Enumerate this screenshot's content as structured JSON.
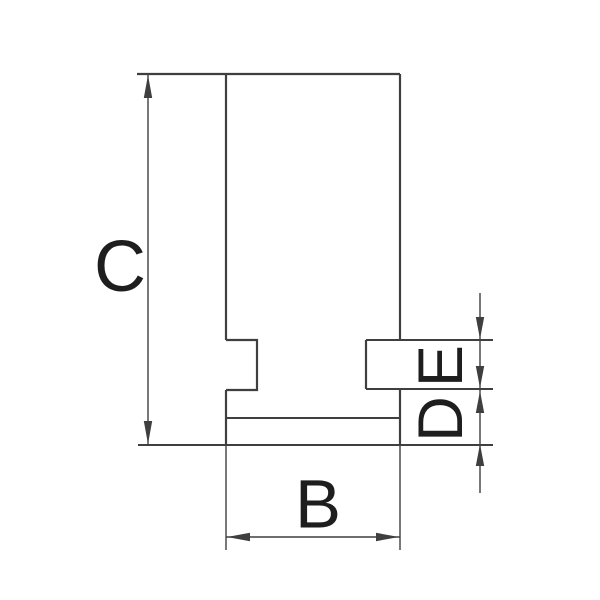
{
  "drawing": {
    "type": "technical-dimension-drawing",
    "background_color": "#ffffff",
    "line_color": "#3f3f3f",
    "label_color": "#1e1e1e",
    "dimensions": {
      "height": {
        "label": "C"
      },
      "width": {
        "label": "B"
      },
      "tenon_height": {
        "label": "E"
      },
      "step_height": {
        "label": "D"
      }
    }
  }
}
